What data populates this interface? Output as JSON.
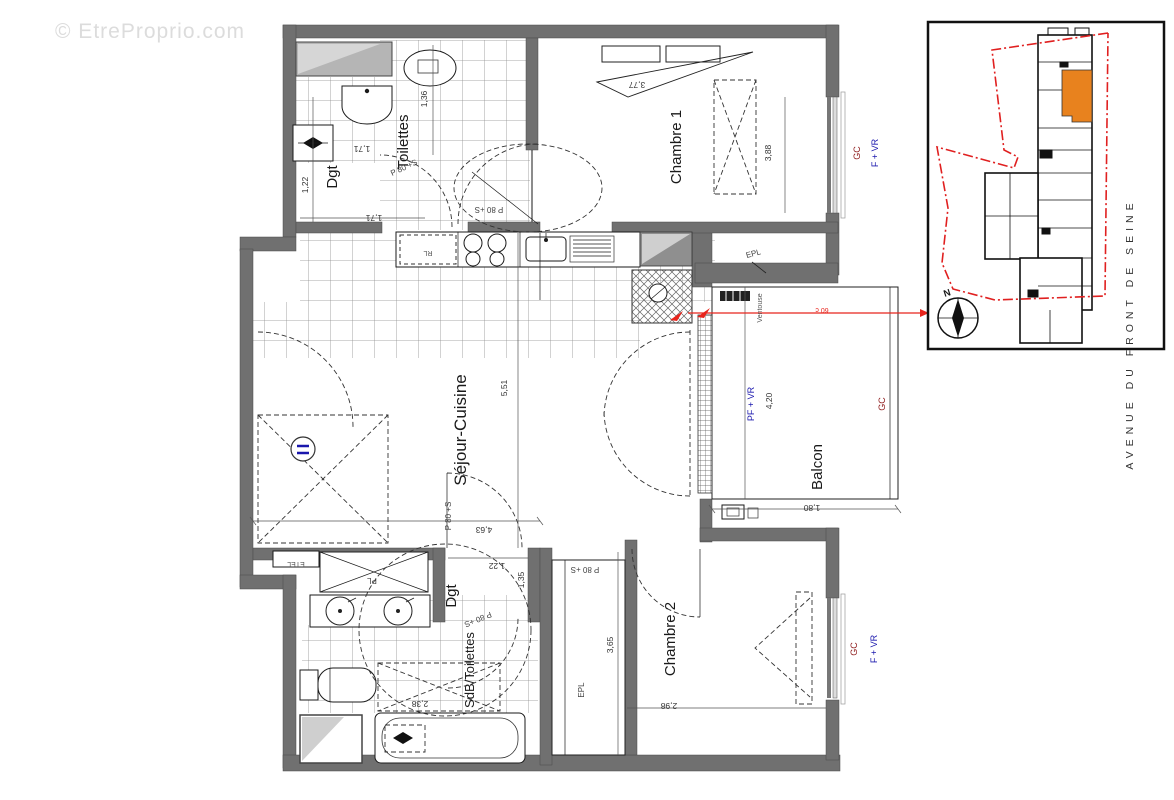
{
  "watermark": {
    "text": "© EtreProprio.com"
  },
  "plan": {
    "rooms": {
      "toilettes": "Toilettes",
      "dgt1": "Dgt",
      "chambre1": "Chambre 1",
      "sejour": "Séjour-Cuisine",
      "balcon": "Balcon",
      "dgt2": "Dgt",
      "sdb": "SdB/Toilettes",
      "chambre2": "Chambre 2"
    },
    "closets": {
      "pl": "PL",
      "etel": "ETEL",
      "epl1": "EPL",
      "epl2": "EPL",
      "rl": "RL"
    },
    "doors": {
      "d1": "P 80 +S",
      "d2": "P 80 +S",
      "d3": "P 80 +S",
      "d4": "P 80 +S",
      "d5": "P 80 +S"
    },
    "windows": {
      "gc1": "GC",
      "fvr1": "F + VR",
      "gc2": "GC",
      "pfvr": "PF + VR",
      "gc3": "GC",
      "fvr2": "F + VR"
    },
    "dims": {
      "d122a": "1,22",
      "d171a": "1,71",
      "d171b": "1,71",
      "d136": "1,36",
      "d377": "3,77",
      "d388": "3,88",
      "d551": "5,51",
      "d420": "4,20",
      "d180": "1,80",
      "d463": "4,63",
      "d122b": "1,22",
      "d135": "1,35",
      "d365": "3,65",
      "d298": "2,98",
      "d238": "2,38"
    },
    "annotations": {
      "ventouse": "Ventouse",
      "vent_dim": "60 c"
    }
  },
  "inset": {
    "street": "AVENUE DU FRONT DE SEINE",
    "north": "N"
  },
  "colors": {
    "wall": "#707070",
    "red_annotation": "#e8241c",
    "boundary_red": "#e02020",
    "window_label_red": "#8f1d1d",
    "window_label_blue": "#1a17ad",
    "highlight_orange": "#e8821e",
    "watermark_gray": "#dcdcdc"
  }
}
